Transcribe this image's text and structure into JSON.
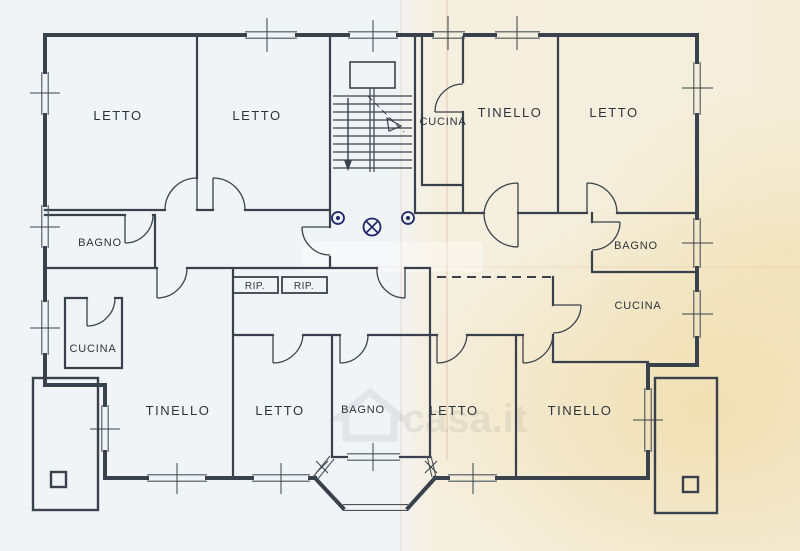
{
  "document": {
    "kind": "apartment floor plan (scanned drawing)",
    "watermark": {
      "text": "casa.it"
    }
  },
  "colors": {
    "ink": "#39424c",
    "ink_light": "#4a535c",
    "paper_left": "#f1f4f6",
    "paper_right": "#f4edda",
    "crease": "#c7765c",
    "symbol_blue": "#1d2668"
  },
  "rooms": {
    "letto_tl1": {
      "label": "LETTO"
    },
    "letto_tl2": {
      "label": "LETTO"
    },
    "bagno_l": {
      "label": "BAGNO"
    },
    "cucina_l": {
      "label": "CUCINA"
    },
    "tinello_bl": {
      "label": "TINELLO"
    },
    "letto_bl": {
      "label": "LETTO"
    },
    "bagno_bc": {
      "label": "BAGNO"
    },
    "letto_br": {
      "label": "LETTO"
    },
    "tinello_br": {
      "label": "TINELLO"
    },
    "cucina_tc": {
      "label": "CUCINA"
    },
    "tinello_tr": {
      "label": "TINELLO"
    },
    "letto_tr": {
      "label": "LETTO"
    },
    "bagno_r": {
      "label": "BAGNO"
    },
    "cucina_r": {
      "label": "CUCINA"
    },
    "rip_1": {
      "label": "RIP."
    },
    "rip_2": {
      "label": "RIP."
    }
  },
  "symbols": [
    {
      "name": "door-viewer-icon",
      "glyph": "circle-with-dot"
    },
    {
      "name": "ceiling-light-icon",
      "glyph": "circle-with-cross"
    },
    {
      "name": "door-viewer-icon",
      "glyph": "circle-with-dot"
    },
    {
      "name": "stair-direction-arrow",
      "glyph": "down-arrow"
    }
  ]
}
